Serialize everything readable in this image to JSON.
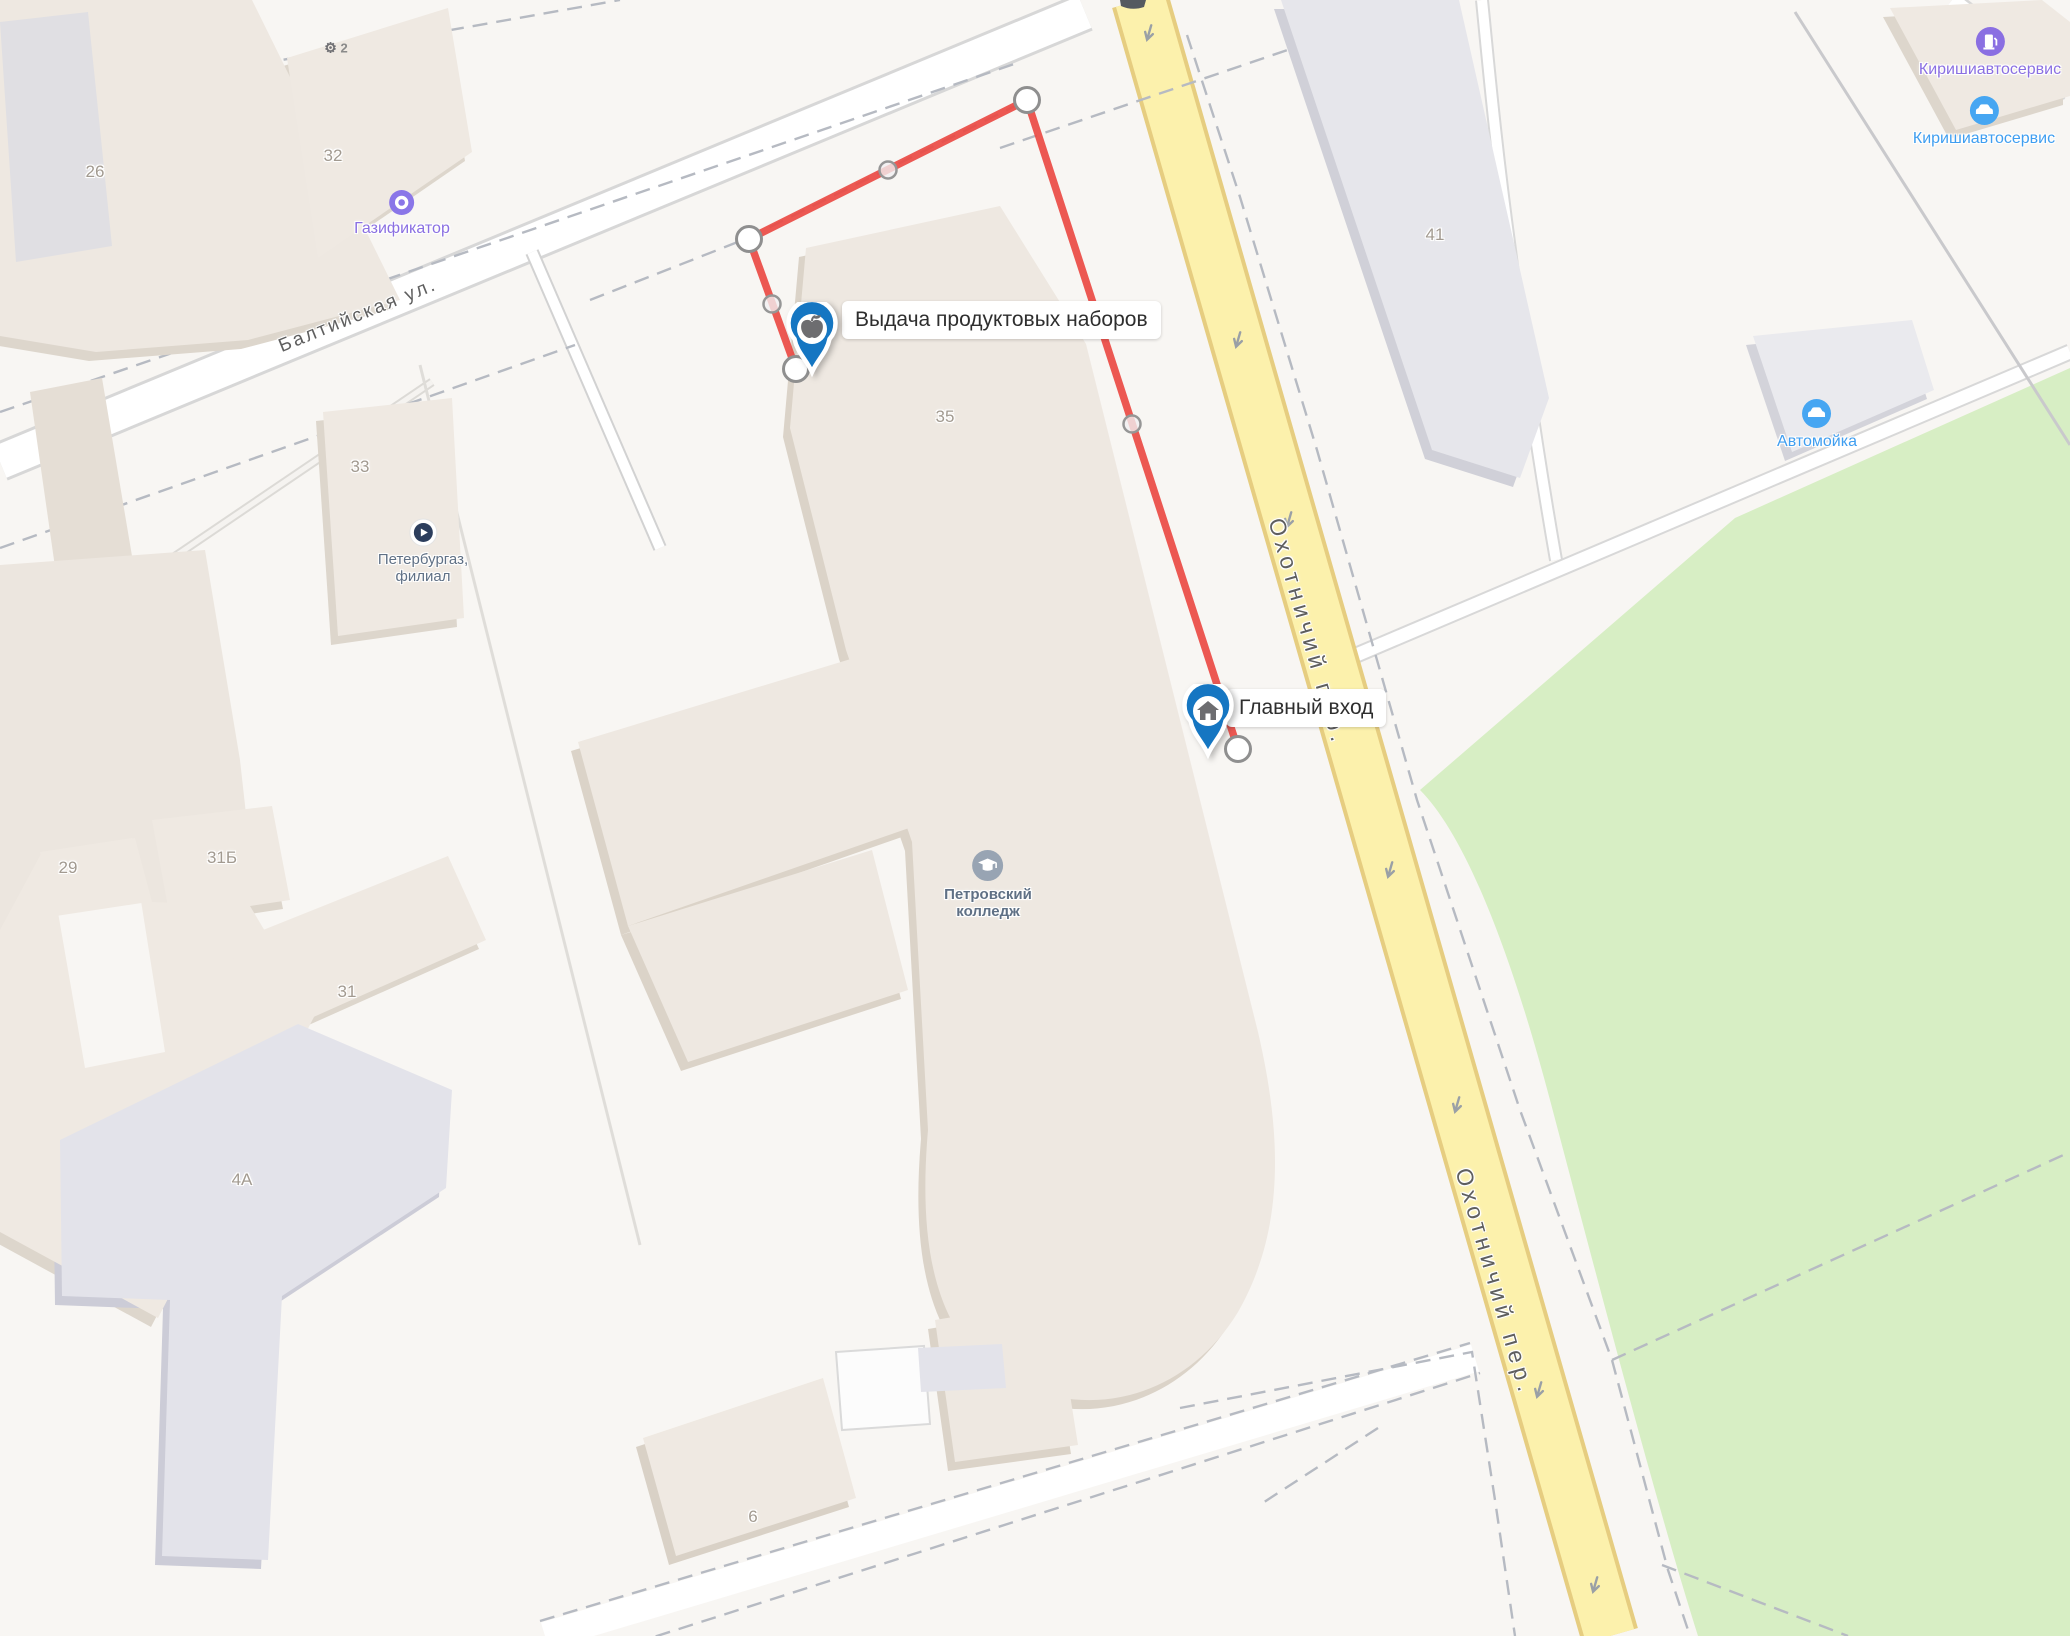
{
  "app": "map-view",
  "colors": {
    "route_red": "#ea4a44",
    "pin_blue": "#1576c2",
    "road_yellow": "#fcf1ac",
    "road_yellow_casing": "#e6cd80",
    "park_green": "#d7eec4",
    "building_beige": "#efe9e2",
    "building_gray": "#e6e6eb",
    "poi_purple": "#8a6fe2",
    "poi_blue": "#3f9ef0",
    "poi_slate": "#5f7085"
  },
  "streets": [
    {
      "label": "Балтийская ул."
    },
    {
      "label": "Охотничий пер."
    },
    {
      "label": "Охотничий пер."
    }
  ],
  "buildings": [
    {
      "number": "26"
    },
    {
      "number": "32"
    },
    {
      "number": "33"
    },
    {
      "number": "35"
    },
    {
      "number": "29"
    },
    {
      "number": "31Б"
    },
    {
      "number": "31"
    },
    {
      "number": "4А"
    },
    {
      "number": "6"
    },
    {
      "number": "41"
    }
  ],
  "pois": [
    {
      "label": "Газификатор"
    },
    {
      "line1": "Петербургаз,",
      "line2": "филиал"
    },
    {
      "line1": "Петровский",
      "line2": "колледж"
    },
    {
      "label": "Киришиавтосервис"
    },
    {
      "label": "Киришиавтосервис"
    },
    {
      "label": "Автомойка"
    },
    {
      "label": "2"
    }
  ],
  "placemarks": [
    {
      "label": "Выдача продуктовых наборов",
      "icon": "apple"
    },
    {
      "label": "Главный вход",
      "icon": "house"
    }
  ],
  "route": {
    "color": "#ea4a44",
    "leg1": [
      [
        1027,
        100
      ],
      [
        749,
        239
      ],
      [
        796,
        369
      ]
    ],
    "leg2": [
      [
        1027,
        100
      ],
      [
        1238,
        749
      ]
    ],
    "vertices": [
      [
        1027,
        100
      ],
      [
        749,
        239
      ],
      [
        796,
        369
      ],
      [
        1238,
        749
      ]
    ],
    "midpoints": [
      [
        888,
        170
      ],
      [
        772,
        304
      ],
      [
        1132,
        424
      ]
    ]
  }
}
